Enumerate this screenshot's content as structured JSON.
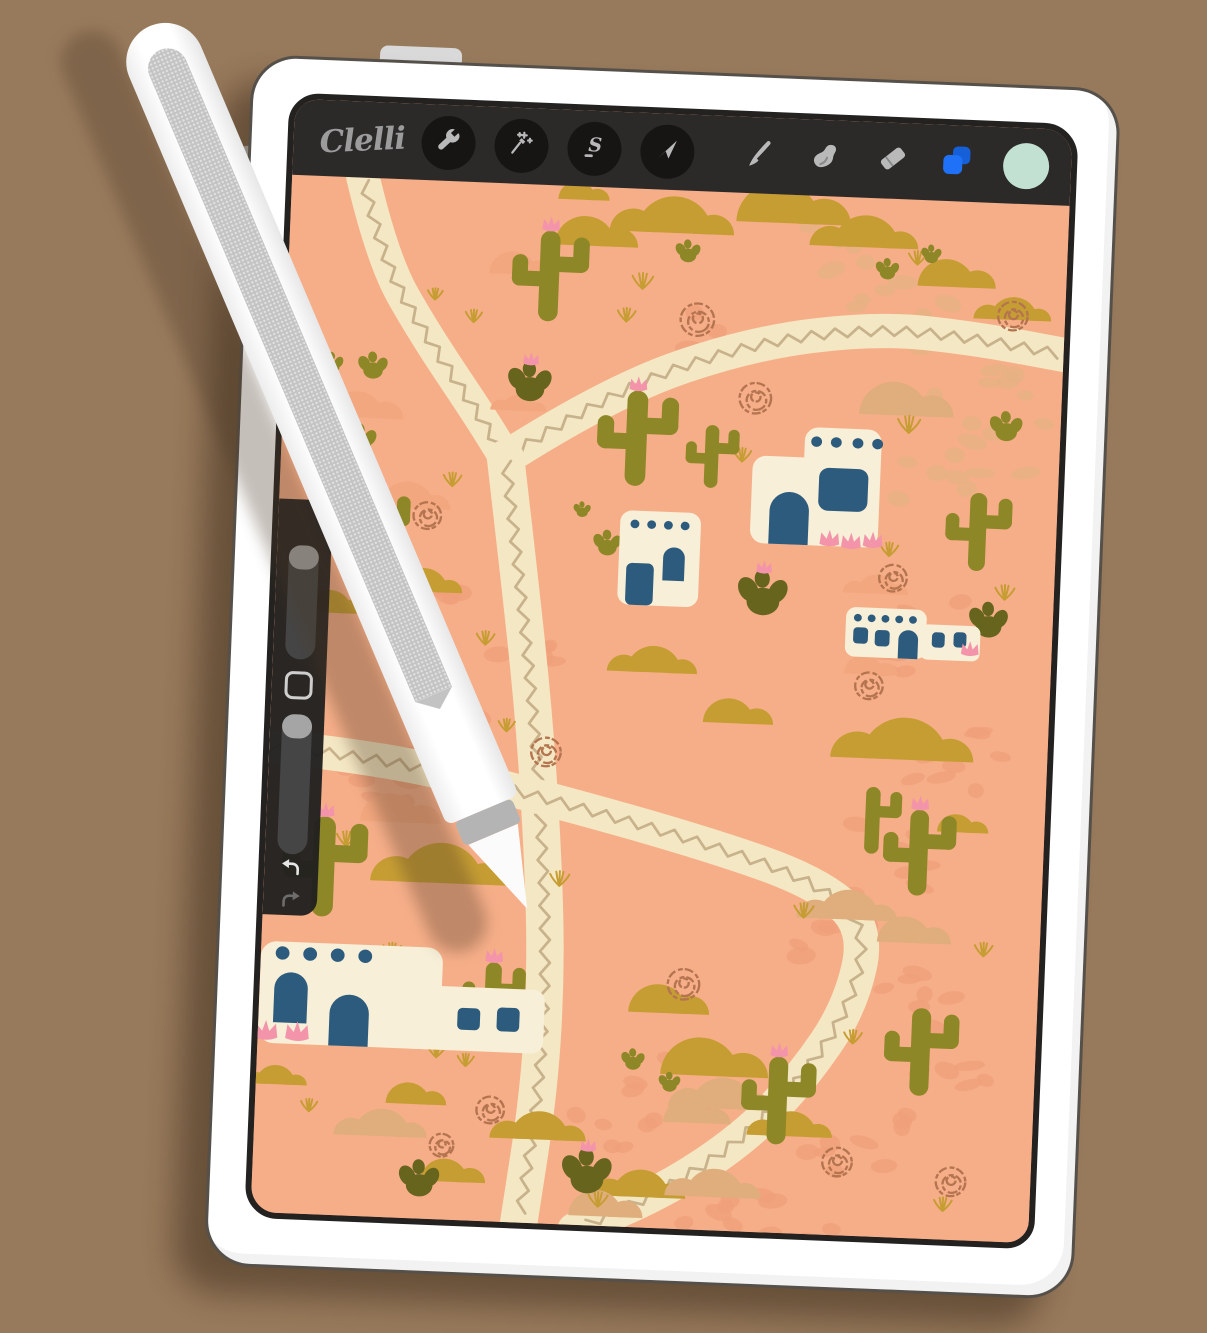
{
  "toolbar": {
    "logo": "Clelli",
    "left_buttons": [
      {
        "name": "actions",
        "icon": "wrench-icon"
      },
      {
        "name": "adjustments",
        "icon": "magic-wand-icon"
      },
      {
        "name": "selection",
        "icon": "selection-s-icon"
      },
      {
        "name": "transform",
        "icon": "transform-arrow-icon"
      }
    ],
    "right_buttons": [
      {
        "name": "paint",
        "icon": "brush-icon"
      },
      {
        "name": "smudge",
        "icon": "smudge-finger-icon"
      },
      {
        "name": "erase",
        "icon": "eraser-icon"
      },
      {
        "name": "layers",
        "icon": "layers-icon",
        "color": "#1f72f7"
      },
      {
        "name": "color",
        "icon": "color-swatch",
        "color": "#c3e1d2"
      }
    ]
  },
  "sidebar": {
    "controls": [
      "brush-size-slider",
      "modify-button",
      "opacity-slider",
      "undo-button",
      "redo-button"
    ]
  },
  "pencil": {
    "style": "white stylus with flat gray side, band and conical tip"
  },
  "palette": {
    "wall": "#97795b",
    "canvas": "#f6ae88",
    "cream": "#f4e7c3",
    "zigzag": "#c8b28c",
    "gold": "#c69d33",
    "tan": "#e0ad7c",
    "pale": "#f3a77e",
    "cobbleDark": "#ef9f79",
    "cobbleTan": "#e6b284",
    "olive": "#8e8727",
    "oliveDark": "#66641d",
    "navy": "#2d5b7d",
    "houseCream": "#f7efd7",
    "pink": "#f394aa",
    "rust": "#b4744f",
    "toolbarBg": "#2b2a29",
    "circleBg": "#161514",
    "iconGray": "#b9b9b9",
    "logoGray": "#9c9c9c",
    "layersBlueFront": "#1f72f7",
    "layersBlueBack": "#155fd8",
    "mint": "#c3e1d2",
    "sidebarBg": "#21201f",
    "trackGray": "#454545",
    "handleGray": "#a5a5a5"
  },
  "canvas": {
    "scene": {
      "paths": [
        {
          "w": 34,
          "pts": [
            [
              72,
              0
            ],
            [
              95,
              85
            ],
            [
              140,
              160
            ],
            [
              200,
              245
            ],
            [
              228,
              288
            ]
          ]
        },
        {
          "w": 36,
          "pts": [
            [
              228,
              288
            ],
            [
              330,
              215
            ],
            [
              470,
              158
            ],
            [
              600,
              136
            ],
            [
              700,
              143
            ],
            [
              800,
              158
            ]
          ]
        },
        {
          "w": 38,
          "pts": [
            [
              228,
              288
            ],
            [
              248,
              420
            ],
            [
              267,
              555
            ],
            [
              281,
              690
            ],
            [
              290,
              820
            ],
            [
              288,
              950
            ],
            [
              272,
              1095
            ]
          ]
        },
        {
          "w": 36,
          "pts": [
            [
              -15,
              600
            ],
            [
              110,
              606
            ],
            [
              290,
              645
            ],
            [
              450,
              685
            ],
            [
              560,
              720
            ],
            [
              615,
              765
            ],
            [
              600,
              850
            ],
            [
              555,
              925
            ],
            [
              500,
              990
            ],
            [
              420,
              1050
            ],
            [
              330,
              1095
            ]
          ]
        }
      ],
      "cobbles": [
        [
          620,
          85,
          60,
          8,
          1
        ],
        [
          700,
          170,
          55,
          8,
          1
        ],
        [
          560,
          50,
          45,
          6,
          1
        ],
        [
          730,
          255,
          50,
          7,
          1
        ],
        [
          640,
          460,
          55,
          8,
          0
        ],
        [
          690,
          590,
          55,
          8,
          0
        ],
        [
          650,
          695,
          50,
          7,
          0
        ],
        [
          590,
          770,
          45,
          6,
          0
        ],
        [
          680,
          845,
          50,
          7,
          0
        ],
        [
          620,
          1000,
          55,
          8,
          0
        ],
        [
          480,
          1052,
          50,
          7,
          0
        ],
        [
          350,
          1012,
          55,
          8,
          0
        ],
        [
          420,
          935,
          45,
          6,
          0
        ],
        [
          120,
          628,
          50,
          7,
          0
        ],
        [
          160,
          455,
          40,
          6,
          0
        ],
        [
          180,
          545,
          40,
          6,
          0
        ],
        [
          250,
          478,
          35,
          5,
          0
        ],
        [
          545,
          1075,
          45,
          6,
          0
        ],
        [
          700,
          930,
          45,
          6,
          0
        ],
        [
          665,
          300,
          40,
          5,
          1
        ],
        [
          430,
          150,
          35,
          5,
          0
        ]
      ],
      "hills": [
        [
          300,
          62,
          62,
          "g"
        ],
        [
          390,
          45,
          80,
          "g"
        ],
        [
          495,
          30,
          85,
          "g"
        ],
        [
          585,
          52,
          70,
          "g"
        ],
        [
          668,
          90,
          58,
          "g"
        ],
        [
          738,
          122,
          50,
          "g"
        ],
        [
          290,
          14,
          38,
          "g"
        ],
        [
          150,
          432,
          52,
          "g"
        ],
        [
          55,
          458,
          48,
          "g"
        ],
        [
          387,
          507,
          58,
          "g"
        ],
        [
          465,
          557,
          52,
          "g"
        ],
        [
          645,
          588,
          92,
          "g"
        ],
        [
          700,
          662,
          38,
          "g"
        ],
        [
          180,
          737,
          88,
          "g"
        ],
        [
          450,
          928,
          80,
          "g"
        ],
        [
          290,
          1002,
          62,
          "g"
        ],
        [
          195,
          1050,
          48,
          "g"
        ],
        [
          395,
          1058,
          60,
          "g"
        ],
        [
          155,
          970,
          45,
          "g"
        ],
        [
          20,
          955,
          42,
          "g"
        ],
        [
          405,
          864,
          60,
          "g"
        ],
        [
          545,
          988,
          55,
          "g"
        ],
        [
          620,
          227,
          70,
          "t"
        ],
        [
          595,
          758,
          65,
          "t"
        ],
        [
          652,
          780,
          55,
          "t"
        ],
        [
          475,
          962,
          68,
          "t"
        ],
        [
          440,
          978,
          50,
          "t"
        ],
        [
          130,
          1005,
          60,
          "t"
        ],
        [
          350,
          1080,
          55,
          "t"
        ],
        [
          470,
          1055,
          62,
          "t"
        ],
        [
          75,
          252,
          55,
          "p"
        ],
        [
          130,
          345,
          58,
          "p"
        ],
        [
          125,
          675,
          60,
          "p"
        ],
        [
          610,
          415,
          42,
          "p"
        ],
        [
          228,
          95,
          48,
          "p"
        ],
        [
          240,
          238,
          36,
          "p"
        ],
        [
          600,
          500,
          40,
          "p"
        ]
      ],
      "tumbleweeds": [
        [
          418,
          135,
          17
        ],
        [
          480,
          215,
          16
        ],
        [
          738,
          118,
          15
        ],
        [
          627,
          398,
          14
        ],
        [
          607,
          512,
          14
        ],
        [
          202,
          573,
          13
        ],
        [
          282,
          595,
          15
        ],
        [
          152,
          352,
          14
        ],
        [
          431,
          833,
          16
        ],
        [
          594,
          1013,
          15
        ],
        [
          710,
          1029,
          15
        ],
        [
          240,
          973,
          14
        ],
        [
          192,
          1012,
          12
        ]
      ],
      "grass": [
        [
          360,
          105,
          14
        ],
        [
          636,
          245,
          15
        ],
        [
          740,
          416,
          13
        ],
        [
          621,
          375,
          12
        ],
        [
          468,
          282,
          12
        ],
        [
          300,
          735,
          13
        ],
        [
          82,
          702,
          13
        ],
        [
          133,
          816,
          12
        ],
        [
          549,
          758,
          13
        ],
        [
          733,
          791,
          12
        ],
        [
          439,
          927,
          12
        ],
        [
          604,
          888,
          12
        ],
        [
          352,
          1070,
          13
        ],
        [
          702,
          1060,
          12
        ],
        [
          55,
          982,
          11
        ],
        [
          345,
          140,
          12
        ],
        [
          175,
          320,
          12
        ],
        [
          215,
          485,
          12
        ],
        [
          240,
          575,
          11
        ],
        [
          182,
          920,
          12
        ],
        [
          212,
          928,
          11
        ],
        [
          638,
          68,
          12
        ],
        [
          150,
          125,
          10
        ],
        [
          190,
          147,
          11
        ]
      ],
      "saguaros": [
        [
          265,
          48,
          95,
          1,
          2
        ],
        [
          360,
          212,
          100,
          1,
          2
        ],
        [
          437,
          245,
          66,
          0,
          2
        ],
        [
          710,
          305,
          82,
          0,
          2
        ],
        [
          100,
          328,
          80,
          1,
          1
        ],
        [
          615,
          618,
          70,
          0,
          1
        ],
        [
          663,
          640,
          90,
          1,
          2
        ],
        [
          60,
          672,
          105,
          1,
          2
        ],
        [
          237,
          818,
          78,
          1,
          2
        ],
        [
          530,
          905,
          92,
          1,
          2
        ],
        [
          673,
          848,
          92,
          0,
          2
        ]
      ],
      "pears": [
        [
          48,
          200,
          15,
          0,
          0
        ],
        [
          90,
          202,
          19,
          0,
          0
        ],
        [
          250,
          215,
          28,
          1,
          1
        ],
        [
          405,
          68,
          16,
          0,
          0
        ],
        [
          80,
          280,
          21,
          0,
          0
        ],
        [
          308,
          342,
          11,
          0,
          0
        ],
        [
          335,
          378,
          18,
          0,
          0
        ],
        [
          495,
          428,
          32,
          1,
          1
        ],
        [
          725,
          445,
          25,
          0,
          1
        ],
        [
          735,
          240,
          21,
          0,
          0
        ],
        [
          608,
          78,
          15,
          0,
          0
        ],
        [
          652,
          60,
          13,
          0,
          0
        ],
        [
          340,
          1042,
          32,
          1,
          1
        ],
        [
          170,
          1055,
          26,
          0,
          1
        ],
        [
          382,
          918,
          15,
          0,
          0
        ],
        [
          420,
          940,
          14,
          0,
          0
        ]
      ],
      "houses": [
        {
          "dotR": 5.5,
          "blocks": [
            [
              479,
              275,
              84,
              92,
              14
            ],
            [
              531,
              243,
              78,
              124,
              14
            ]
          ],
          "dots": [
            [
              543,
              258
            ],
            [
              563,
              258
            ],
            [
              585,
              258
            ],
            [
              605,
              258
            ]
          ],
          "arches": [
            [
              498,
              312,
              40,
              55
            ]
          ],
          "rects": [
            [
              547,
              285,
              50,
              45,
              10
            ]
          ],
          "flowers": [
            [
              560,
              360,
              10
            ],
            [
              582,
              362,
              10
            ],
            [
              604,
              360,
              10
            ]
          ]
        },
        {
          "dotR": 4.5,
          "blocks": [
            [
              347,
              338,
              82,
              99,
              12
            ]
          ],
          "dots": [
            [
              362,
              352
            ],
            [
              379,
              352
            ],
            [
              396,
              352
            ],
            [
              413,
              352
            ]
          ],
          "arches": [
            [
              392,
              375,
              22,
              35
            ]
          ],
          "rects": [
            [
              355,
              393,
              28,
              44,
              6
            ]
          ],
          "flowers": []
        },
        {
          "dotR": 4,
          "blocks": [
            [
              580,
              430,
              82,
              52,
              10
            ],
            [
              656,
              445,
              61,
              37,
              8
            ]
          ],
          "dots": [
            [
              592,
              441
            ],
            [
              606,
              441
            ],
            [
              620,
              441
            ],
            [
              634,
              441
            ],
            [
              648,
              441
            ]
          ],
          "arches": [
            [
              634,
              452,
              20,
              30
            ]
          ],
          "rects": [
            [
              588,
              451,
              15,
              17,
              4
            ],
            [
              610,
              453,
              15,
              17,
              4
            ],
            [
              668,
              453,
              13,
              16,
              4
            ],
            [
              690,
              452,
              13,
              16,
              4
            ]
          ],
          "flowers": [
            [
              707,
              470,
              9
            ]
          ]
        },
        {
          "dotR": 7,
          "blocks": [
            [
              0,
              805,
              185,
              107,
              16
            ],
            [
              140,
              845,
              150,
              67,
              12
            ]
          ],
          "dots": [
            [
              22,
              817
            ],
            [
              50,
              817
            ],
            [
              78,
              817
            ],
            [
              106,
              817
            ]
          ],
          "arches": [
            [
              15,
              837,
              34,
              53
            ],
            [
              72,
              858,
              40,
              54
            ]
          ],
          "rects": [
            [
              202,
              867,
              23,
              23,
              5
            ],
            [
              242,
              865,
              23,
              25,
              5
            ]
          ],
          "flowers": [
            [
              8,
              900,
              12
            ],
            [
              40,
              900,
              12
            ]
          ]
        }
      ]
    }
  }
}
